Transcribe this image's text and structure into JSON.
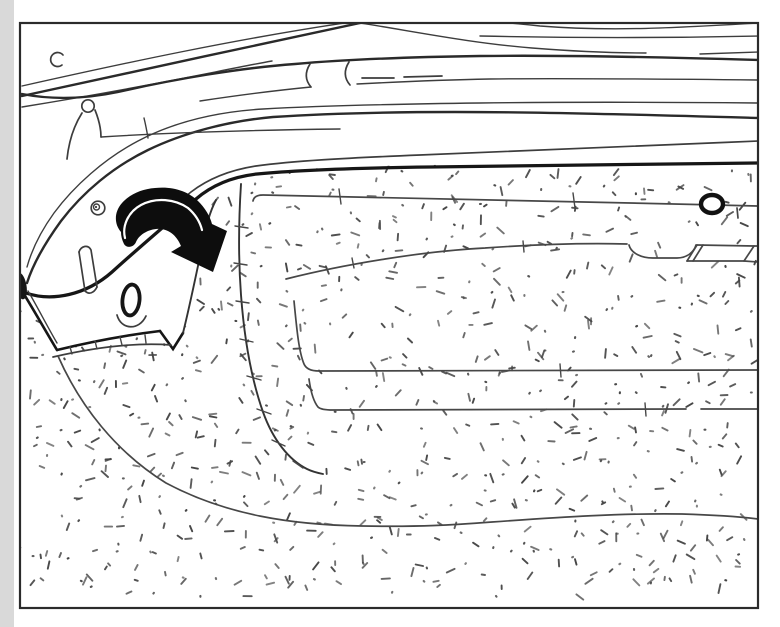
{
  "figure": {
    "type": "technical-line-illustration",
    "subject": "vehicle luggage compartment (trunk) interior",
    "description": "Manual-style drawing showing the rear side trim corner being folded back over the trunk floor carpet; a solid black curved arrow indicates the fold-over direction (down and to the right).",
    "text_content": "none — the illustration contains no words or numbers"
  },
  "canvas": {
    "width": 780,
    "height": 627,
    "frame": {
      "x": 20,
      "y": 23,
      "w": 738,
      "h": 585
    }
  },
  "colors": {
    "background": "#ffffff",
    "page_shade": "#d9d9d9",
    "frame": "#2b2b2b",
    "line": "#3d3d3d",
    "line_strong": "#2a2a2a",
    "bold": "#161616",
    "arrow_fill": "#0d0d0d",
    "arrow_highlight": "#ffffff",
    "seam": "#474747",
    "fold_line": "#333333",
    "stipple": "#454545"
  },
  "stipple": {
    "seed": 20240613,
    "step": 15,
    "keep": 0.6,
    "min_len": 3,
    "max_len": 9,
    "dot_ratio": 0.28,
    "top": 168,
    "bottom": 600,
    "left": 26,
    "right": 752
  },
  "elements": [
    {
      "name": "illustration-frame",
      "desc": "thin rectangular border around the drawing"
    },
    {
      "name": "trunk-lid-seal-lines",
      "desc": "sweeping parallel lines of the trunk opening / weatherstrip channel across the top"
    },
    {
      "name": "seal-fork-detail",
      "desc": "pointed lens-like fork of lines, top middle-right"
    },
    {
      "name": "seal-clamp-detail",
      "desc": "small clamp joint with two dashes, top centre"
    },
    {
      "name": "clip-tower",
      "desc": "small mound with round clip head, upper left"
    },
    {
      "name": "c-clip",
      "desc": "small open circle near the top-left corner"
    },
    {
      "name": "spiral-grommet",
      "desc": "small spiral grommet on the left arc band"
    },
    {
      "name": "side-trim-panel",
      "desc": "white trim wedge at the left with slot and oval hole"
    },
    {
      "name": "trim-oval-hole",
      "desc": "bold oval opening in the trim panel"
    },
    {
      "name": "trim-corner-flap",
      "desc": "folded lower corner of the trim with stitched edge"
    },
    {
      "name": "fold-arrow",
      "desc": "solid black curved arrow showing fold-over direction"
    },
    {
      "name": "carpet",
      "desc": "stippled trunk floor carpeting filling the lower area"
    },
    {
      "name": "carpet-fold-line",
      "desc": "curved crease line with small cross ticks running down the carpet"
    },
    {
      "name": "carpet-seams",
      "desc": "long seam lines across the carpet"
    },
    {
      "name": "oval-grommet",
      "desc": "bold oval ring on the upper-right seam"
    },
    {
      "name": "pull-handle-recess",
      "desc": "recessed pocket and slanted handle plate, middle right"
    },
    {
      "name": "hinge-blob",
      "desc": "dark hinge mass at the left border"
    }
  ]
}
